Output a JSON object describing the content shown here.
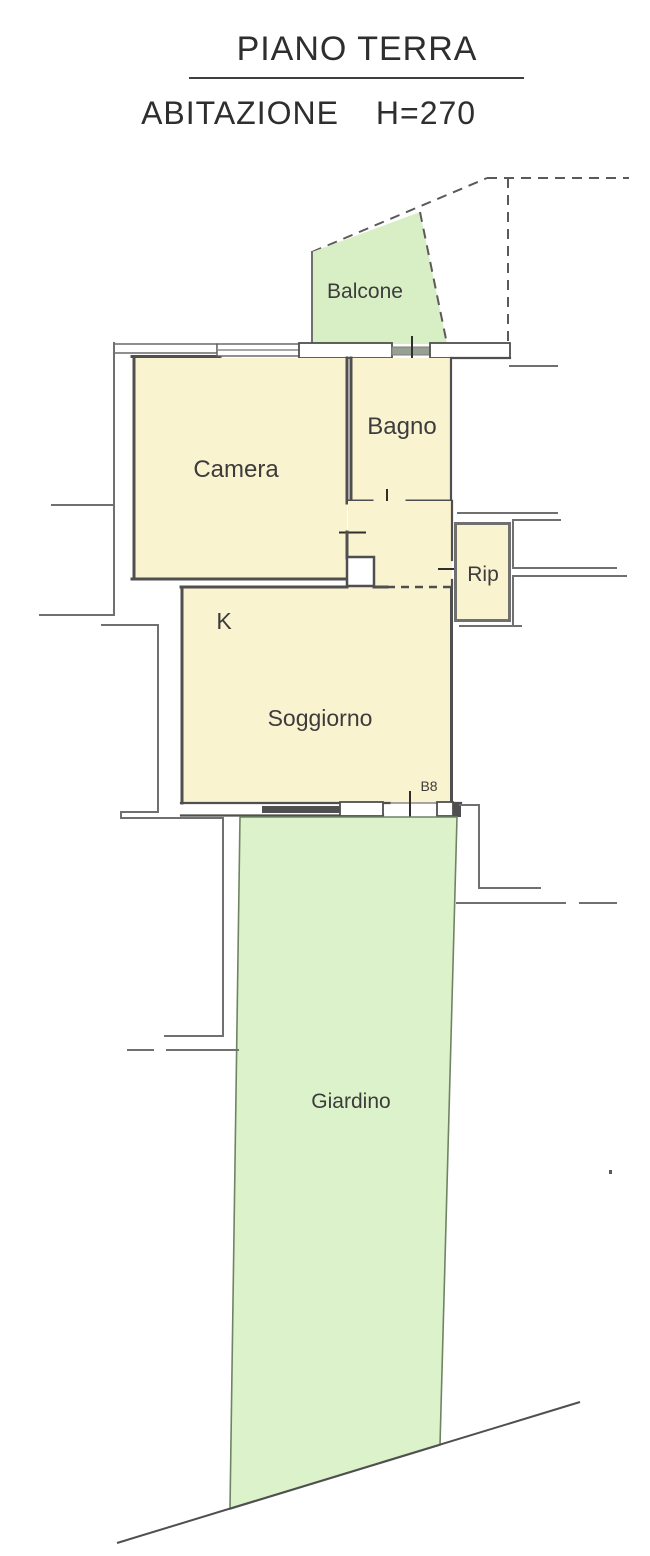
{
  "title": {
    "line1": "PIANO TERRA",
    "line2_left": "ABITAZIONE",
    "line2_right": "H=270"
  },
  "rooms": {
    "balcone": {
      "label": "Balcone"
    },
    "camera": {
      "label": "Camera"
    },
    "bagno": {
      "label": "Bagno"
    },
    "rip": {
      "label": "Rip"
    },
    "kitchen": {
      "label": "K"
    },
    "soggiorno": {
      "label": "Soggiorno"
    },
    "giardino": {
      "label": "Giardino"
    }
  },
  "annotations": {
    "entry_door": "B8"
  },
  "colors": {
    "room_fill": "#faf3d0",
    "garden_fill": "#dcf2ca",
    "balcony_fill": "#d8efc5",
    "wall": "#4f4f4f",
    "boundary": "#707070",
    "text": "#3c3c3c"
  }
}
